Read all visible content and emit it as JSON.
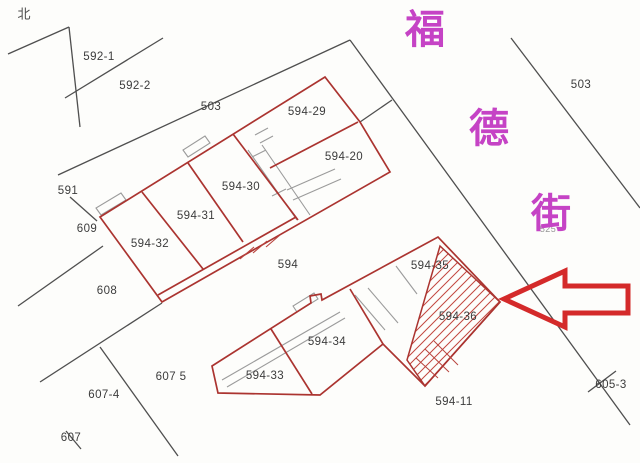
{
  "compass": {
    "label": "北"
  },
  "street": {
    "name": "福德街",
    "color": "#c543c5",
    "chars": [
      {
        "text": "福",
        "x": 425,
        "y": 26
      },
      {
        "text": "德",
        "x": 489,
        "y": 125
      },
      {
        "text": "街",
        "x": 551,
        "y": 210
      }
    ]
  },
  "highlight": {
    "arrow_color": "#d42a2a",
    "hatched_parcel": "594-36"
  },
  "colors": {
    "boundary_black": "#4f4f4f",
    "parcel_red": "#ab3430",
    "sliver_gray": "#9b9b9b",
    "label_text": "#3c3c3c"
  },
  "parcel_labels": [
    {
      "text": "592-1",
      "x": 99,
      "y": 57
    },
    {
      "text": "592-2",
      "x": 135,
      "y": 86
    },
    {
      "text": "503",
      "x": 211,
      "y": 107
    },
    {
      "text": "503",
      "x": 581,
      "y": 85
    },
    {
      "text": "594-29",
      "x": 307,
      "y": 112
    },
    {
      "text": "594-20",
      "x": 344,
      "y": 157
    },
    {
      "text": "594-30",
      "x": 241,
      "y": 187
    },
    {
      "text": "594-31",
      "x": 196,
      "y": 216
    },
    {
      "text": "594-32",
      "x": 150,
      "y": 244
    },
    {
      "text": "591",
      "x": 68,
      "y": 191
    },
    {
      "text": "609",
      "x": 87,
      "y": 229
    },
    {
      "text": "608",
      "x": 107,
      "y": 291
    },
    {
      "text": "594",
      "x": 288,
      "y": 265
    },
    {
      "text": "594-35",
      "x": 430,
      "y": 266
    },
    {
      "text": "594-36",
      "x": 458,
      "y": 317
    },
    {
      "text": "594-34",
      "x": 327,
      "y": 342
    },
    {
      "text": "594-33",
      "x": 265,
      "y": 376
    },
    {
      "text": "607 5",
      "x": 171,
      "y": 377
    },
    {
      "text": "607-4",
      "x": 104,
      "y": 395
    },
    {
      "text": "607",
      "x": 71,
      "y": 438
    },
    {
      "text": "594-11",
      "x": 454,
      "y": 402
    },
    {
      "text": "605-3",
      "x": 611,
      "y": 385
    },
    {
      "text": "525",
      "x": 548,
      "y": 229,
      "size": 9,
      "color": "#979797"
    }
  ]
}
